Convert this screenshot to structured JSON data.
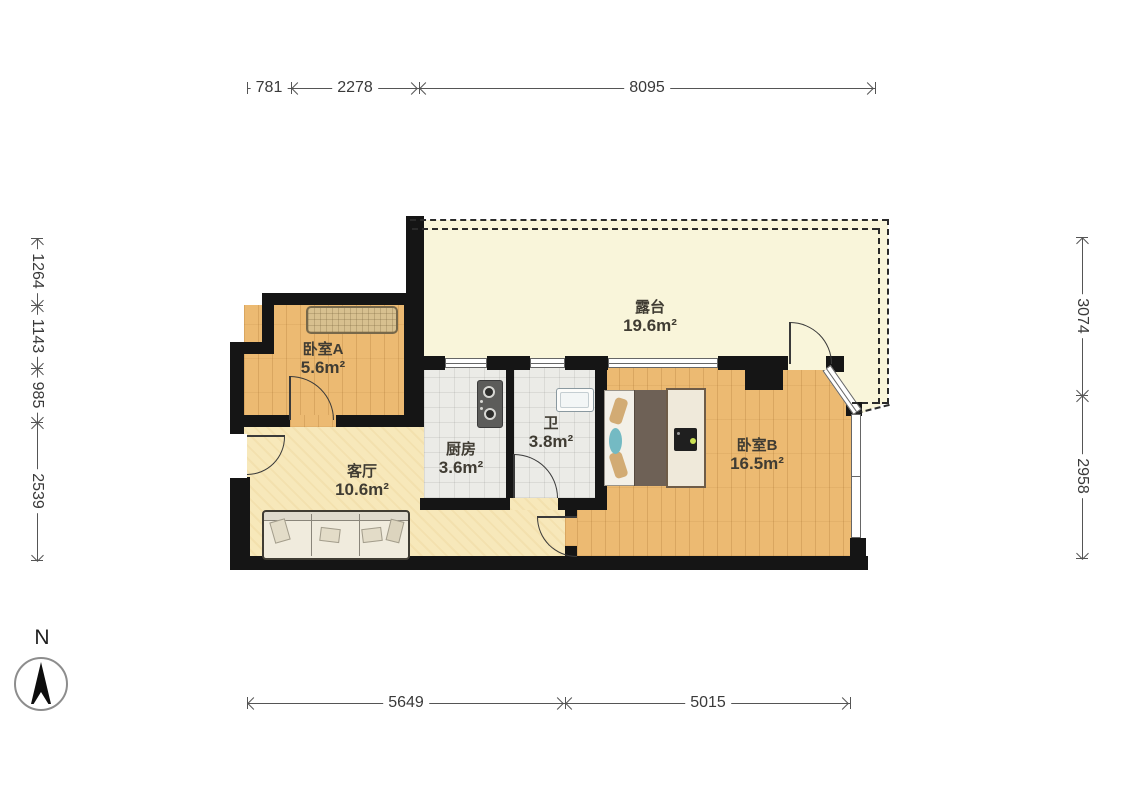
{
  "rooms": {
    "bedroom_a": {
      "name": "卧室A",
      "area": "5.6m²"
    },
    "living": {
      "name": "客厅",
      "area": "10.6m²"
    },
    "kitchen": {
      "name": "厨房",
      "area": "3.6m²"
    },
    "bath": {
      "name": "卫",
      "area": "3.8m²"
    },
    "bedroom_b": {
      "name": "卧室B",
      "area": "16.5m²"
    },
    "terrace": {
      "name": "露台",
      "area": "19.6m²"
    }
  },
  "dimensions": {
    "top": [
      "781",
      "2278",
      "8095"
    ],
    "bottom": [
      "5649",
      "5015"
    ],
    "left": [
      "1264",
      "1143",
      "985",
      "2539"
    ],
    "right": [
      "3074",
      "2958"
    ]
  },
  "compass": {
    "north": "N"
  },
  "colors": {
    "wall": "#151515",
    "wood_floor": "#ecba72",
    "living_floor": "#f7e8ba",
    "tile_floor": "#ebebe7",
    "terrace_floor": "#f9f5da"
  }
}
